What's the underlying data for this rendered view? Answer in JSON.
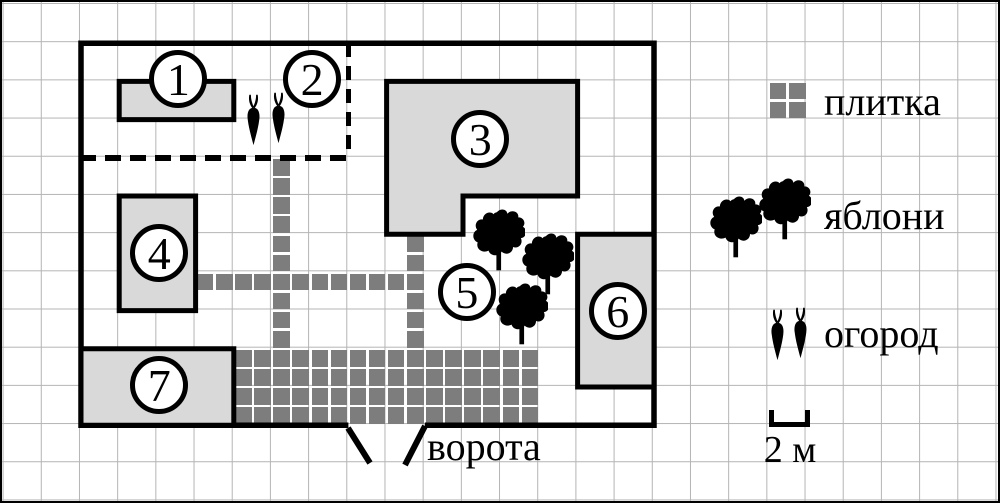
{
  "title": "План дачного участка",
  "palette": {
    "outline": "#000000",
    "building_fill": "#d9d9d9",
    "tile_color": "#7d7d7d",
    "grid_line": "#b4b4b4",
    "background": "#ffffff"
  },
  "grid": {
    "cell_px": 38.2,
    "origin_x": 2.6,
    "origin_y": 3.0,
    "meters_per_cell": 2
  },
  "plan": {
    "plot_m": {
      "x": 4,
      "y": 2,
      "w": 30,
      "h": 20
    },
    "gate_opening_m": {
      "x1": 18,
      "x2": 22
    },
    "dashed_subplot_m": {
      "x": 4,
      "y": 2,
      "w": 14,
      "h": 6
    },
    "buildings": [
      {
        "id": "building-1",
        "marker": "1",
        "points_m": [
          [
            6,
            4
          ],
          [
            12,
            4
          ],
          [
            12,
            6
          ],
          [
            6,
            6
          ]
        ]
      },
      {
        "id": "building-3",
        "marker": "3",
        "points_m": [
          [
            20,
            4
          ],
          [
            30,
            4
          ],
          [
            30,
            10
          ],
          [
            24,
            10
          ],
          [
            24,
            12
          ],
          [
            20,
            12
          ]
        ]
      },
      {
        "id": "building-4",
        "marker": "4",
        "points_m": [
          [
            6,
            10
          ],
          [
            10,
            10
          ],
          [
            10,
            16
          ],
          [
            6,
            16
          ]
        ]
      },
      {
        "id": "building-6",
        "marker": "6",
        "points_m": [
          [
            30,
            12
          ],
          [
            34,
            12
          ],
          [
            34,
            20
          ],
          [
            30,
            20
          ]
        ]
      },
      {
        "id": "building-7",
        "marker": "7",
        "points_m": [
          [
            4,
            18
          ],
          [
            12,
            18
          ],
          [
            12,
            22
          ],
          [
            4,
            22
          ]
        ]
      }
    ],
    "markers": [
      {
        "n": "1",
        "cx": 9.1,
        "cy": 3.9
      },
      {
        "n": "2",
        "cx": 16.1,
        "cy": 3.9
      },
      {
        "n": "3",
        "cx": 24.9,
        "cy": 7.0
      },
      {
        "n": "4",
        "cx": 8.1,
        "cy": 13.0
      },
      {
        "n": "5",
        "cx": 24.2,
        "cy": 15.0
      },
      {
        "n": "6",
        "cx": 32.1,
        "cy": 16.0
      },
      {
        "n": "7",
        "cx": 8.1,
        "cy": 19.9
      }
    ],
    "tile_paths": [
      {
        "id": "path-vertical-1",
        "x": 14,
        "y": 8,
        "cols": 1,
        "rows": 10
      },
      {
        "id": "path-vertical-2",
        "x": 21,
        "y": 12,
        "cols": 1,
        "rows": 6
      },
      {
        "id": "path-horizontal",
        "x": 10,
        "y": 14,
        "cols": 12,
        "rows": 1
      },
      {
        "id": "patio",
        "x": 12,
        "y": 18,
        "cols": 16,
        "rows": 4
      }
    ],
    "trees_px": [
      [
        471,
        206
      ],
      [
        520,
        230
      ],
      [
        494,
        280
      ]
    ],
    "carrots_px": [
      [
        241,
        92
      ],
      [
        266,
        90
      ]
    ],
    "gate_marks_px": [
      [
        346,
        426,
        368,
        461
      ],
      [
        423,
        424,
        403,
        463
      ]
    ]
  },
  "gate": {
    "label": "ворота"
  },
  "legend": {
    "items": [
      {
        "id": "tiles",
        "label": "плитка"
      },
      {
        "id": "apple-trees",
        "label": "яблони"
      },
      {
        "id": "garden",
        "label": "огород"
      }
    ],
    "tile_icon_m": {
      "x": 40,
      "y": 4,
      "cols": 2,
      "rows": 2
    },
    "trees_px": [
      [
        708,
        193
      ],
      [
        757,
        175
      ]
    ],
    "carrots_px": [
      [
        765,
        307
      ],
      [
        788,
        305
      ]
    ],
    "scale": {
      "label": "2 м",
      "meters": 2
    }
  }
}
